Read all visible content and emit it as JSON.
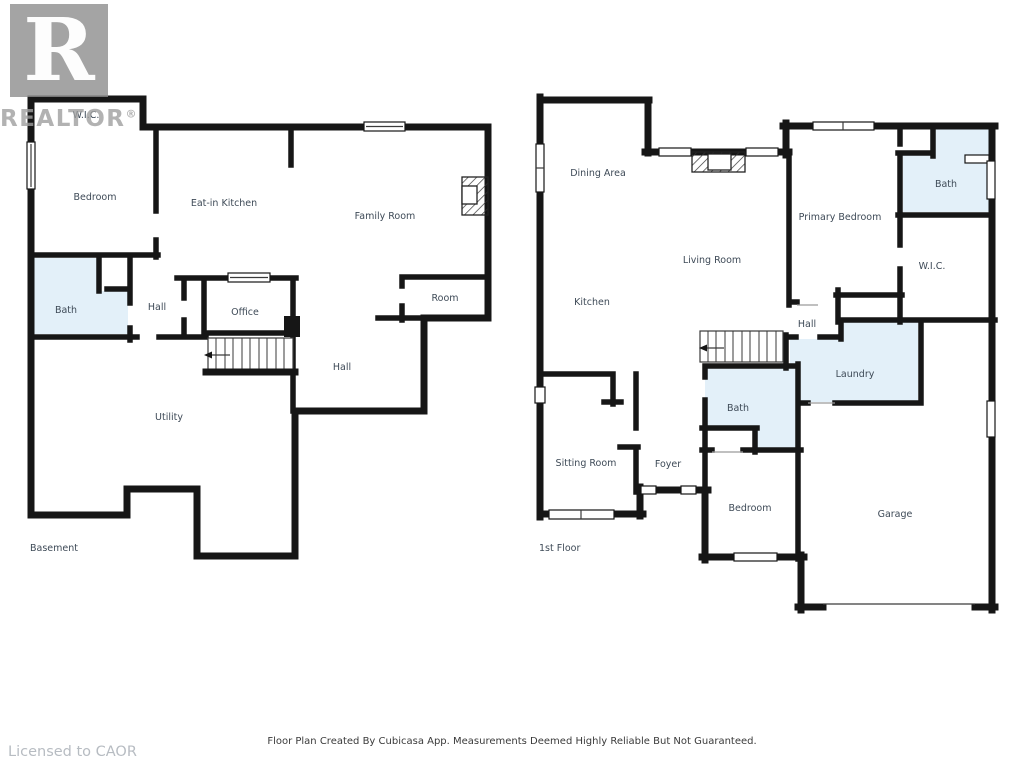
{
  "watermark": {
    "logo_letter": "R",
    "logo_word": "REALTOR",
    "registered_mark": "®",
    "licensed_text": "Licensed to CAOR"
  },
  "footer": {
    "disclaimer": "Floor Plan Created By Cubicasa App. Measurements Deemed Highly Reliable But Not Guaranteed."
  },
  "colors": {
    "walls": "#161616",
    "wet_room_fill": "#e3f0f9",
    "room_label": "#3e4a57",
    "watermark_gray": "#9b9b9b",
    "licensed_gray": "#b7bcc2",
    "disclaimer_text": "#3a3a3a",
    "background": "#ffffff"
  },
  "floors": [
    {
      "name": "Basement",
      "label": "Basement",
      "rooms": [
        {
          "label": "W.I.C."
        },
        {
          "label": "Bedroom"
        },
        {
          "label": "Eat-in Kitchen"
        },
        {
          "label": "Family Room"
        },
        {
          "label": "Bath"
        },
        {
          "label": "Hall"
        },
        {
          "label": "Office"
        },
        {
          "label": "Room"
        },
        {
          "label": "Hall"
        },
        {
          "label": "Utility"
        }
      ]
    },
    {
      "name": "1st Floor",
      "label": "1st Floor",
      "rooms": [
        {
          "label": "Dining Area"
        },
        {
          "label": "Living Room"
        },
        {
          "label": "Kitchen"
        },
        {
          "label": "Primary Bedroom"
        },
        {
          "label": "Bath"
        },
        {
          "label": "W.I.C."
        },
        {
          "label": "Hall"
        },
        {
          "label": "Laundry"
        },
        {
          "label": "Bath"
        },
        {
          "label": "Sitting Room"
        },
        {
          "label": "Foyer"
        },
        {
          "label": "Bedroom"
        },
        {
          "label": "Garage"
        }
      ]
    }
  ]
}
